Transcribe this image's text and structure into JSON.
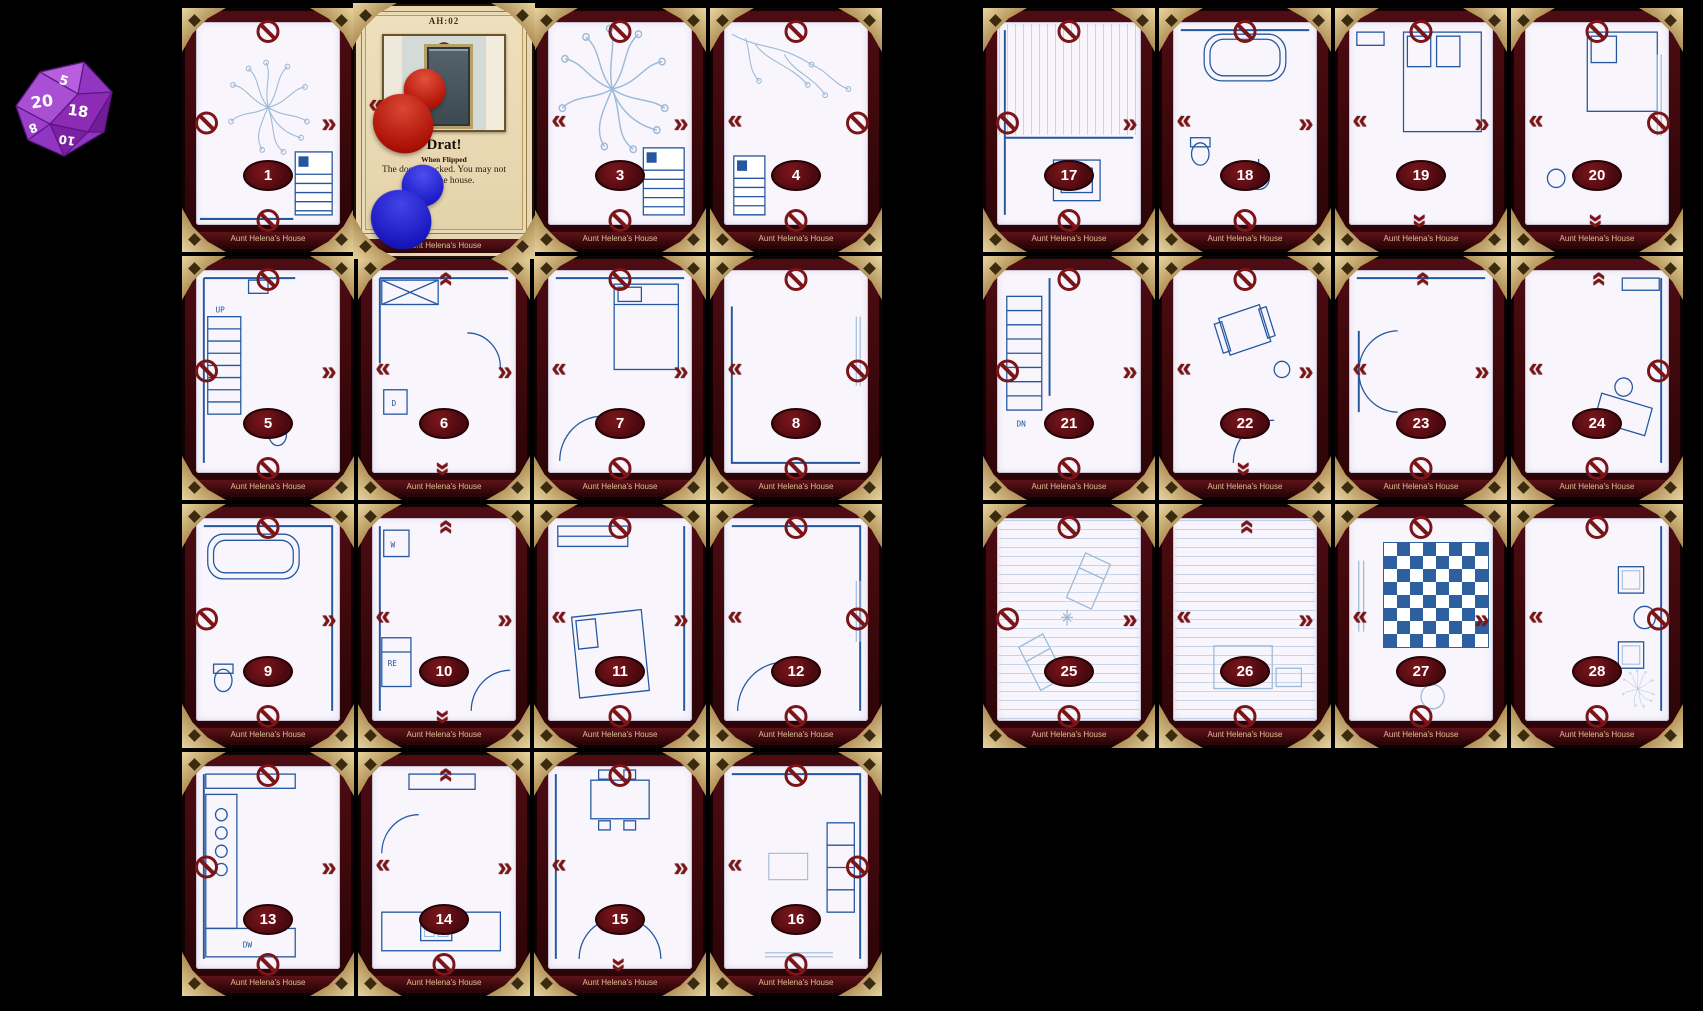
{
  "board": {
    "card_title": "Aunt Helena's House",
    "background_color": "#000000",
    "frame_color": "#40090e",
    "gold_color": "#b89a62",
    "badge_color": "#5c0f14",
    "blueprint_color": "#2457a0",
    "edge_icon_color": "#7b1518",
    "edge_icon_names": {
      "blocked": "no-entry-icon",
      "door": "door-chevron-icon"
    }
  },
  "die": {
    "name": "d20-die",
    "color": "#9136c2",
    "visible_numbers": [
      "20",
      "5",
      "18",
      "8",
      "10"
    ]
  },
  "flipped_card": {
    "code": "AH:02",
    "title": "Drat!",
    "subtitle": "When Flipped",
    "body": "The door is locked. You may not leave the house.",
    "footer": "Aunt Helena's House",
    "tokens": [
      "red-pawn",
      "blue-pawn"
    ]
  },
  "cards": [
    {
      "num": "1",
      "group": "left",
      "col": 0,
      "row": 0,
      "scene": "yard-tree",
      "labels": [],
      "edges": {
        "top": "blocked",
        "right": "door",
        "bottom": "blocked",
        "left": "blocked"
      }
    },
    {
      "num": "3",
      "group": "left",
      "col": 2,
      "row": 0,
      "scene": "yard-tree-2",
      "labels": [],
      "edges": {
        "top": "blocked",
        "right": "door",
        "bottom": "blocked",
        "left": "door"
      }
    },
    {
      "num": "4",
      "group": "left",
      "col": 3,
      "row": 0,
      "scene": "yard-branch",
      "labels": [],
      "edges": {
        "top": "blocked",
        "right": "blocked",
        "bottom": "blocked",
        "left": "door"
      }
    },
    {
      "num": "5",
      "group": "left",
      "col": 0,
      "row": 1,
      "scene": "stairs-up",
      "labels": [
        "UP"
      ],
      "edges": {
        "top": "blocked",
        "right": "door",
        "bottom": "blocked",
        "left": "blocked"
      }
    },
    {
      "num": "6",
      "group": "left",
      "col": 1,
      "row": 1,
      "scene": "utility",
      "labels": [
        "D"
      ],
      "edges": {
        "top": "door",
        "right": "door",
        "bottom": "door",
        "left": "door"
      }
    },
    {
      "num": "7",
      "group": "left",
      "col": 2,
      "row": 1,
      "scene": "bedroom-a",
      "labels": [],
      "edges": {
        "top": "blocked",
        "right": "door",
        "bottom": "blocked",
        "left": "door"
      }
    },
    {
      "num": "8",
      "group": "left",
      "col": 3,
      "row": 1,
      "scene": "room-window",
      "labels": [],
      "edges": {
        "top": "blocked",
        "right": "blocked",
        "bottom": "blocked",
        "left": "door"
      }
    },
    {
      "num": "9",
      "group": "left",
      "col": 0,
      "row": 2,
      "scene": "bath",
      "labels": [],
      "edges": {
        "top": "blocked",
        "right": "door",
        "bottom": "blocked",
        "left": "blocked"
      }
    },
    {
      "num": "10",
      "group": "left",
      "col": 1,
      "row": 2,
      "scene": "laundry",
      "labels": [
        "W",
        "RE"
      ],
      "edges": {
        "top": "door",
        "right": "door",
        "bottom": "door",
        "left": "door"
      }
    },
    {
      "num": "11",
      "group": "left",
      "col": 2,
      "row": 2,
      "scene": "bedroom-b",
      "labels": [],
      "edges": {
        "top": "blocked",
        "right": "door",
        "bottom": "blocked",
        "left": "door"
      }
    },
    {
      "num": "12",
      "group": "left",
      "col": 3,
      "row": 2,
      "scene": "hall",
      "labels": [],
      "edges": {
        "top": "blocked",
        "right": "blocked",
        "bottom": "blocked",
        "left": "door"
      }
    },
    {
      "num": "13",
      "group": "left",
      "col": 0,
      "row": 3,
      "scene": "kitchen",
      "labels": [
        "DW"
      ],
      "edges": {
        "top": "blocked",
        "right": "door",
        "bottom": "blocked",
        "left": "blocked"
      }
    },
    {
      "num": "14",
      "group": "left",
      "col": 1,
      "row": 3,
      "scene": "kitchen-2",
      "labels": [],
      "edges": {
        "top": "door",
        "right": "door",
        "bottom": "blocked",
        "left": "door"
      }
    },
    {
      "num": "15",
      "group": "left",
      "col": 2,
      "row": 3,
      "scene": "dining",
      "labels": [],
      "edges": {
        "top": "blocked",
        "right": "door",
        "bottom": "door",
        "left": "door"
      }
    },
    {
      "num": "16",
      "group": "left",
      "col": 3,
      "row": 3,
      "scene": "living",
      "labels": [],
      "edges": {
        "top": "blocked",
        "right": "blocked",
        "bottom": "blocked",
        "left": "door"
      }
    },
    {
      "num": "17",
      "group": "right",
      "col": 0,
      "row": 0,
      "scene": "porch",
      "labels": [],
      "edges": {
        "top": "blocked",
        "right": "door",
        "bottom": "blocked",
        "left": "blocked"
      }
    },
    {
      "num": "18",
      "group": "right",
      "col": 1,
      "row": 0,
      "scene": "bath-2",
      "labels": [],
      "edges": {
        "top": "blocked",
        "right": "door",
        "bottom": "blocked",
        "left": "door"
      }
    },
    {
      "num": "19",
      "group": "right",
      "col": 2,
      "row": 0,
      "scene": "bedroom-c",
      "labels": [],
      "edges": {
        "top": "blocked",
        "right": "door",
        "bottom": "door",
        "left": "door"
      }
    },
    {
      "num": "20",
      "group": "right",
      "col": 3,
      "row": 0,
      "scene": "bedroom-d",
      "labels": [],
      "edges": {
        "top": "blocked",
        "right": "blocked",
        "bottom": "door",
        "left": "door"
      }
    },
    {
      "num": "21",
      "group": "right",
      "col": 0,
      "row": 1,
      "scene": "stairs-down",
      "labels": [
        "DN"
      ],
      "edges": {
        "top": "blocked",
        "right": "door",
        "bottom": "blocked",
        "left": "blocked"
      }
    },
    {
      "num": "22",
      "group": "right",
      "col": 1,
      "row": 1,
      "scene": "sitting",
      "labels": [],
      "edges": {
        "top": "blocked",
        "right": "door",
        "bottom": "door",
        "left": "door"
      }
    },
    {
      "num": "23",
      "group": "right",
      "col": 2,
      "row": 1,
      "scene": "hall-2",
      "labels": [],
      "edges": {
        "top": "door",
        "right": "door",
        "bottom": "blocked",
        "left": "door"
      }
    },
    {
      "num": "24",
      "group": "right",
      "col": 3,
      "row": 1,
      "scene": "study",
      "labels": [],
      "edges": {
        "top": "door",
        "right": "blocked",
        "bottom": "blocked",
        "left": "door"
      }
    },
    {
      "num": "25",
      "group": "right",
      "col": 0,
      "row": 2,
      "scene": "lounge",
      "labels": [],
      "edges": {
        "top": "blocked",
        "right": "door",
        "bottom": "blocked",
        "left": "blocked"
      }
    },
    {
      "num": "26",
      "group": "right",
      "col": 1,
      "row": 2,
      "scene": "family",
      "labels": [],
      "edges": {
        "top": "door",
        "right": "door",
        "bottom": "blocked",
        "left": "door"
      }
    },
    {
      "num": "27",
      "group": "right",
      "col": 2,
      "row": 2,
      "scene": "game-room",
      "labels": [],
      "edges": {
        "top": "blocked",
        "right": "door",
        "bottom": "blocked",
        "left": "door"
      }
    },
    {
      "num": "28",
      "group": "right",
      "col": 3,
      "row": 2,
      "scene": "sunroom",
      "labels": [],
      "edges": {
        "top": "blocked",
        "right": "blocked",
        "bottom": "blocked",
        "left": "door"
      }
    }
  ]
}
